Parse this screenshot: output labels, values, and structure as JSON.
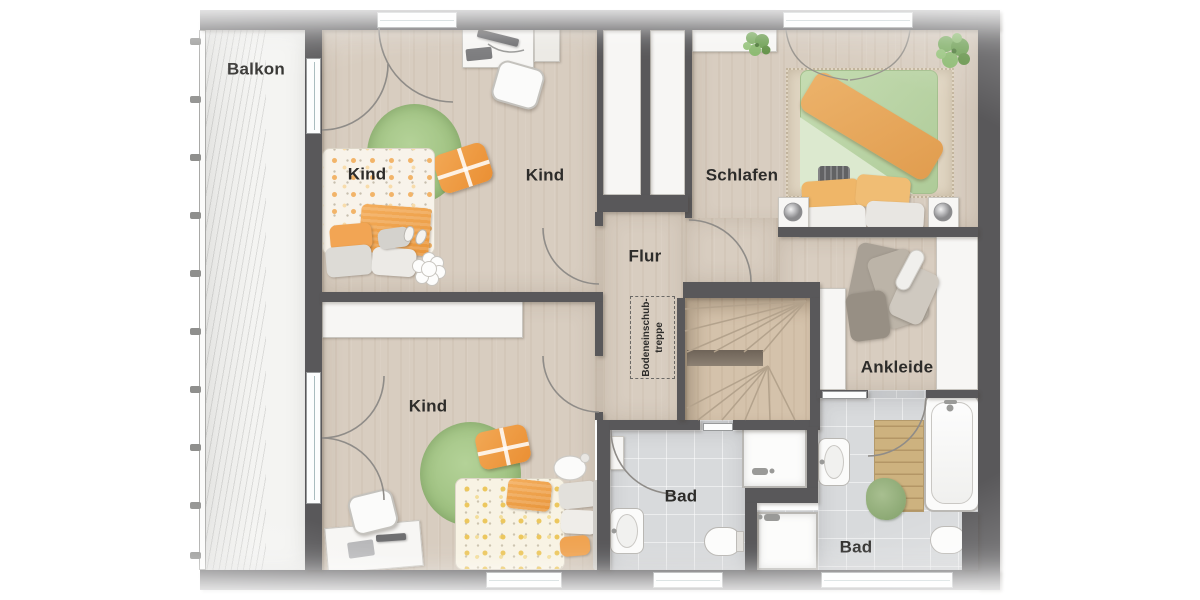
{
  "rooms": {
    "balkon": {
      "label": "Balkon"
    },
    "kind_top": {
      "label": "Kind"
    },
    "kind_top_bed": {
      "label": "Kind"
    },
    "schlafen": {
      "label": "Schlafen"
    },
    "flur": {
      "label": "Flur"
    },
    "kind_bottom": {
      "label": "Kind"
    },
    "bad_center": {
      "label": "Bad"
    },
    "bad_right": {
      "label": "Bad"
    },
    "ankleide": {
      "label": "Ankleide"
    },
    "attic_stairs": {
      "line1": "Bodeneinschub-",
      "line2": "treppe"
    }
  },
  "colors": {
    "wall": "#59585a",
    "wood": "#d8cdc0",
    "wood_dark": "#d3c6b6",
    "stair_wood": "#d4c2ab",
    "tile": "#d8dadc",
    "balcony": "#f4f4f2",
    "rug_green": "#a6c889",
    "accent_orange": "#f0a04f",
    "duvet_green": "#bad3a4",
    "furniture_white": "#f7f6f4",
    "label_text": "#2d2c2a",
    "arc_stroke": "#8f8c88"
  }
}
